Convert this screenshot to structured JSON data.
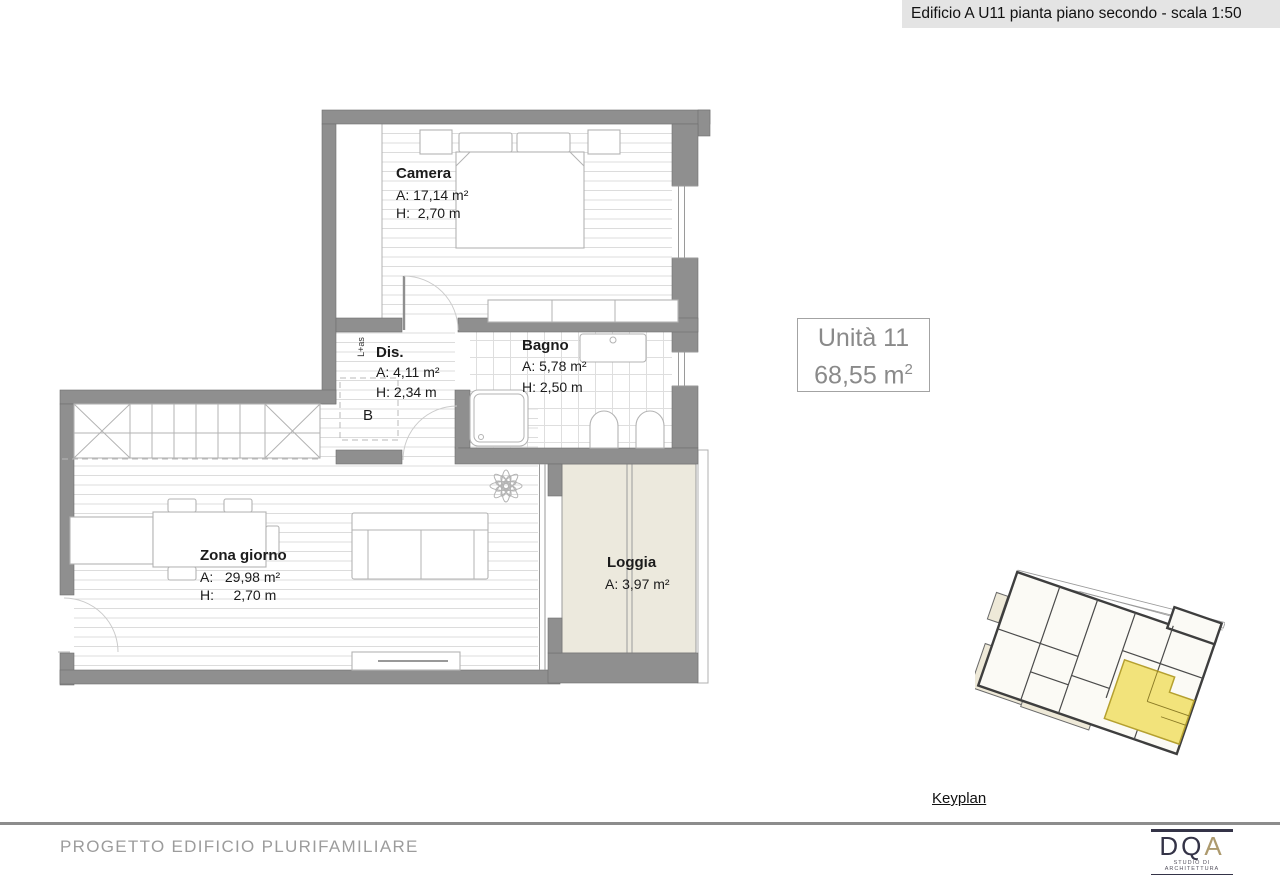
{
  "header": {
    "title": "Edificio A U11 pianta piano secondo - scala 1:50"
  },
  "unit": {
    "name": "Unità 11",
    "area_value": "68,55 m",
    "area_exp": "2"
  },
  "rooms": {
    "camera": {
      "name": "Camera",
      "area": "A: 17,14 m²",
      "height": "H:  2,70 m"
    },
    "dis": {
      "name": "Dis.",
      "area": "A: 4,11 m²",
      "height": "H: 2,34 m"
    },
    "bagno": {
      "name": "Bagno",
      "area": "A: 5,78 m²",
      "height": "H: 2,50 m"
    },
    "zona_giorno": {
      "name": "Zona giorno",
      "area": "A:   29,98 m²",
      "height": "H:     2,70 m"
    },
    "loggia": {
      "name": "Loggia",
      "area": "A: 3,97 m²"
    }
  },
  "plan_annotations": {
    "closet_label": "L+as",
    "boiler_label": "B"
  },
  "keyplan": {
    "label": "Keyplan"
  },
  "footer": {
    "project_title": "PROGETTO EDIFICIO PLURIFAMILIARE",
    "logo": {
      "letters": [
        "D",
        "Q",
        "A"
      ],
      "tagline": "STUDIO DI ARCHITETTURA"
    }
  },
  "colors": {
    "wall": "#8f8f8f",
    "loggia": "#ECE9DD",
    "highlight": "#F2E37B",
    "highlight_border": "#B5A02F",
    "keyplan_fill": "#EEE9D8",
    "header_bg": "#e4e4e4",
    "text_gray": "#8a8a8a",
    "rule": "#8c8c8c",
    "footer_text": "#9c9c9c",
    "logo_navy": "#343347",
    "logo_gold": "#AD9A6E"
  }
}
